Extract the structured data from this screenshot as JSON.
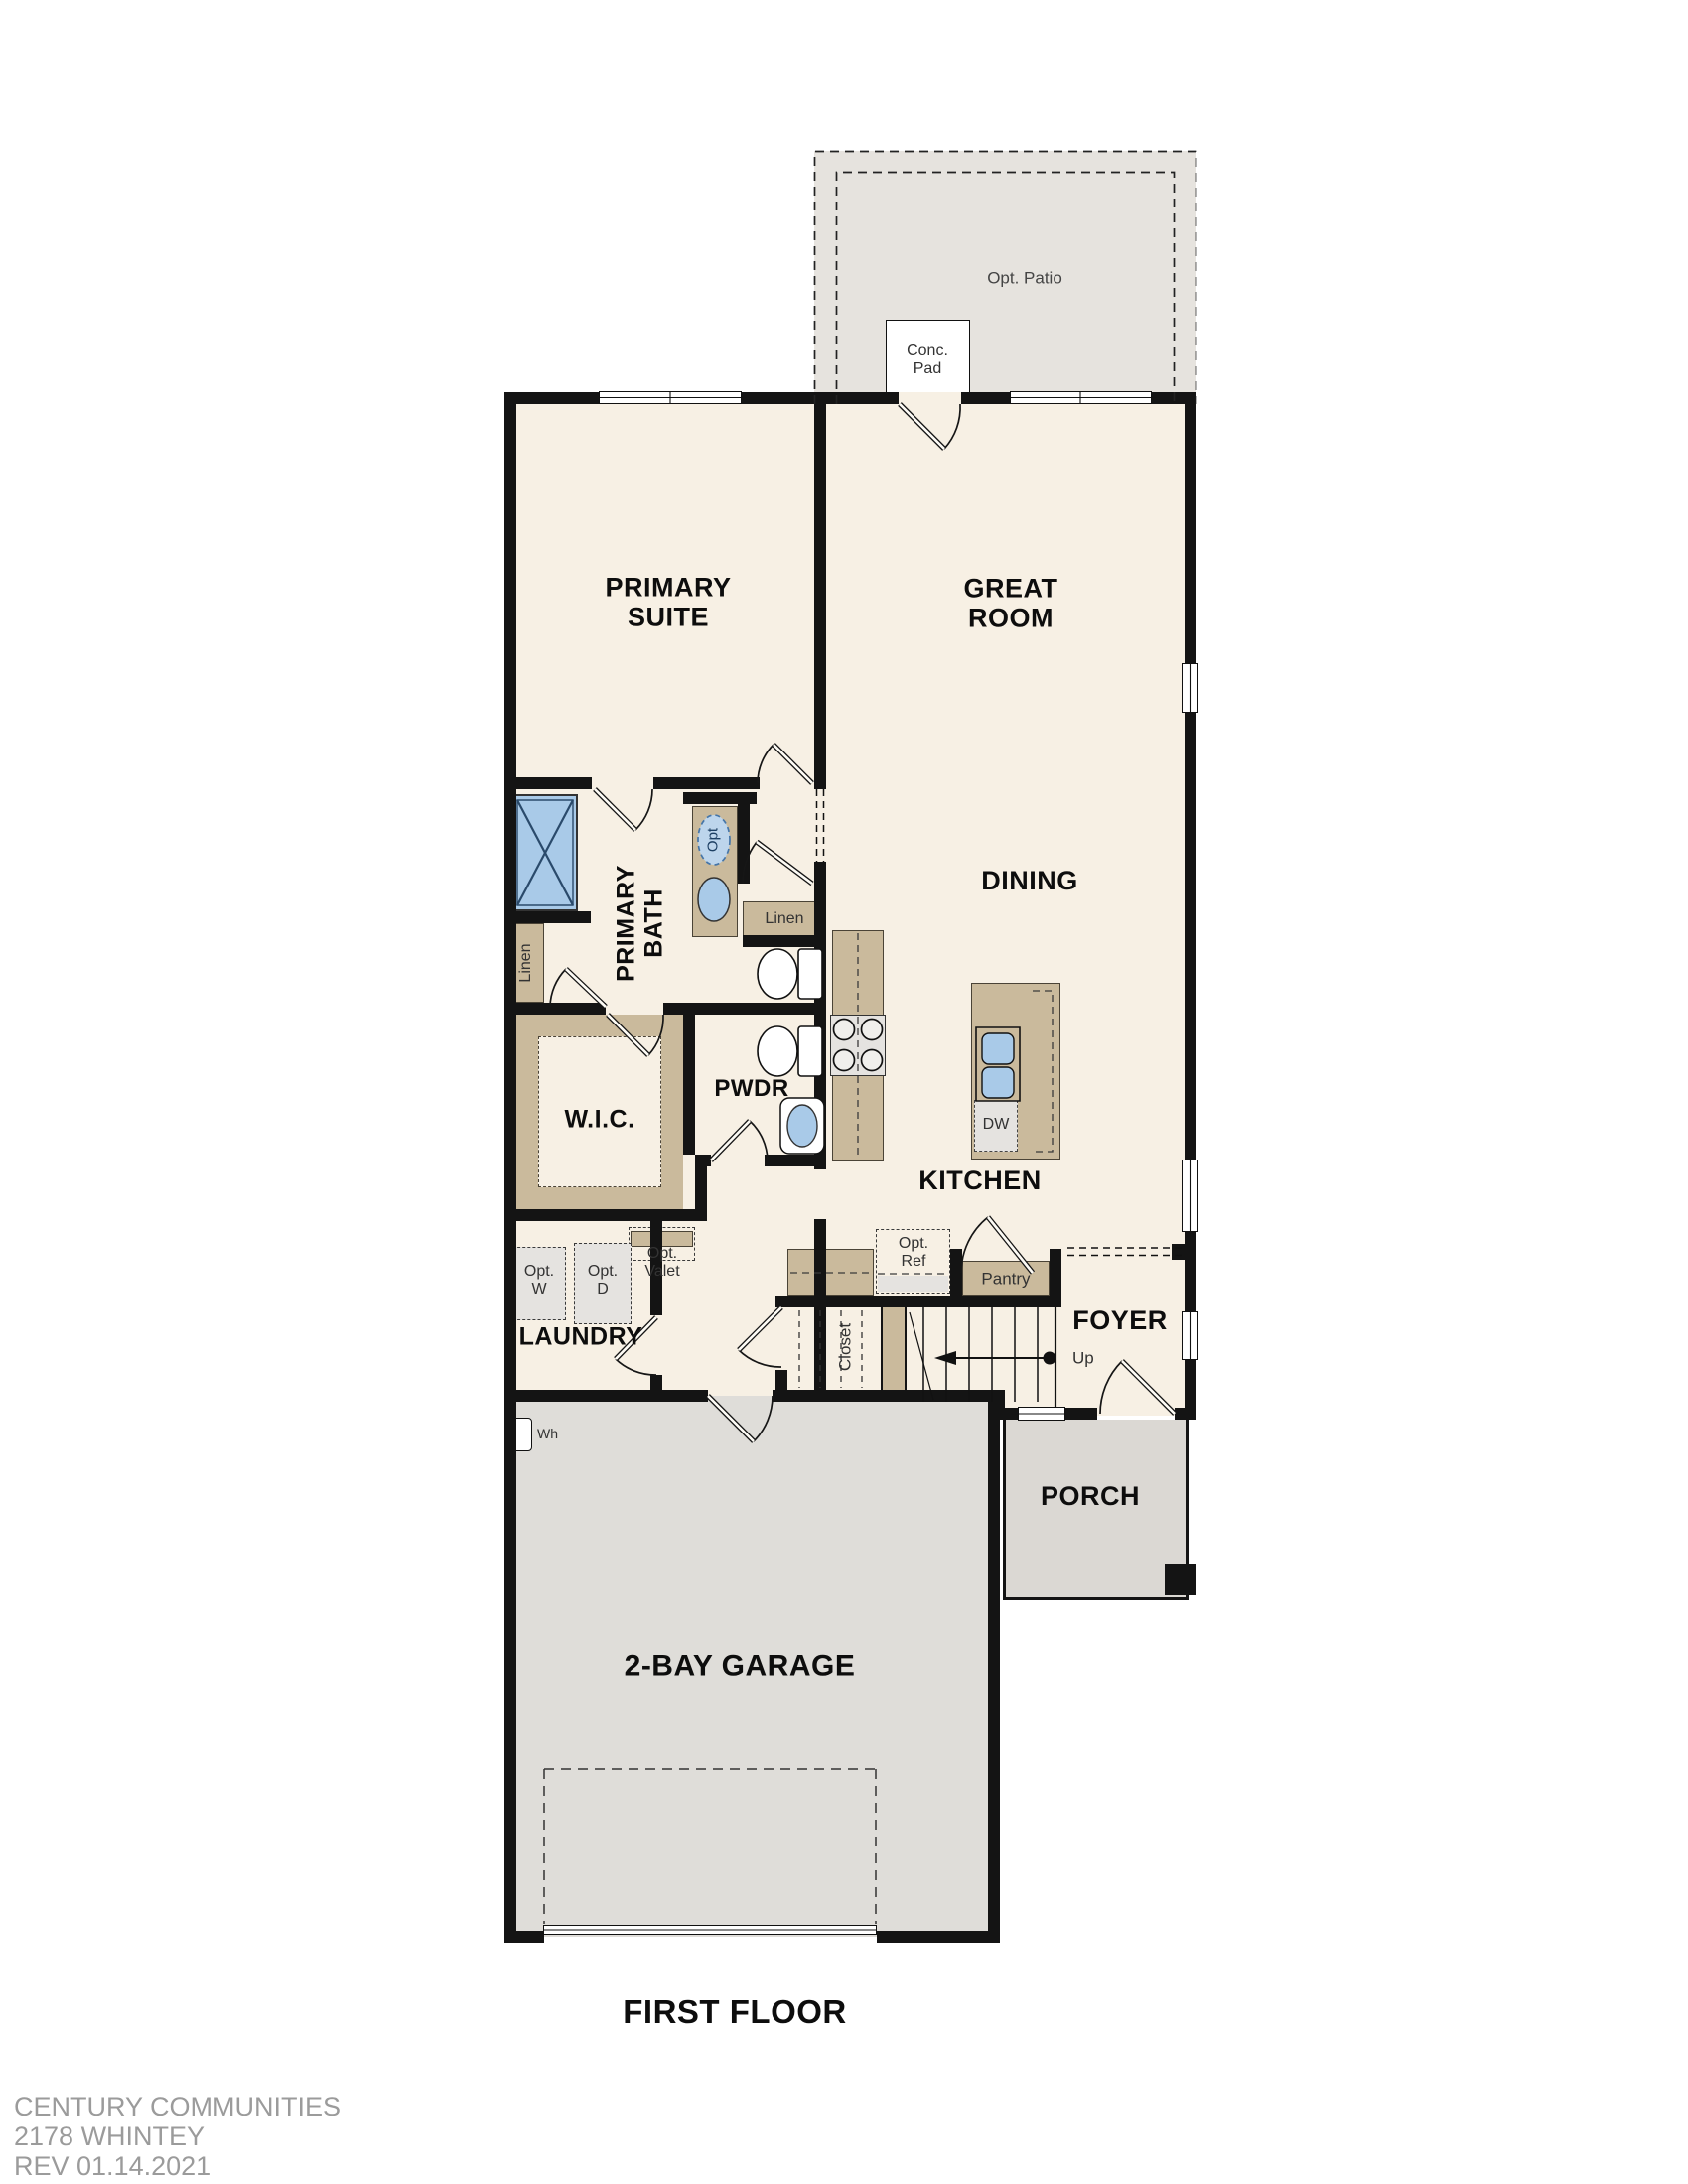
{
  "plan": {
    "first_floor_label": "FIRST FLOOR",
    "footer_line1": "CENTURY COMMUNITIES",
    "footer_line2": "2178 WHINTEY",
    "footer_line3": "REV 01.14.2021"
  },
  "rooms": {
    "primary_suite": "PRIMARY\nSUITE",
    "great_room": "GREAT\nROOM",
    "dining": "DINING",
    "kitchen": "KITCHEN",
    "primary_bath": "PRIMARY\nBATH",
    "wic": "W.I.C.",
    "pwdr": "PWDR",
    "laundry": "LAUNDRY",
    "foyer": "FOYER",
    "porch": "PORCH",
    "garage": "2-BAY GARAGE"
  },
  "annotations": {
    "opt_patio": "Opt. Patio",
    "conc_pad": "Conc.\nPad",
    "linen_left": "Linen",
    "linen_right": "Linen",
    "opt_fixture": "Opt",
    "opt_washer": "Opt.\nW",
    "opt_dryer": "Opt.\nD",
    "opt_valet": "Opt.\nValet",
    "opt_ref": "Opt.\nRef",
    "pantry": "Pantry",
    "closet": "Closet",
    "up": "Up",
    "dishwasher": "DW",
    "water_heater": "Wh"
  },
  "colors": {
    "floor": "#f7f0e4",
    "patio": "#e6e3de",
    "garage": "#dfddd9",
    "porch": "#dbd8d3",
    "cabinet": "#caba9c",
    "appliance": "#e5e3e0",
    "fixture_blue": "#a9cae8",
    "fixture_blue_dark": "#24456a",
    "wall": "#141414",
    "footer_text": "#9b9b9b"
  }
}
